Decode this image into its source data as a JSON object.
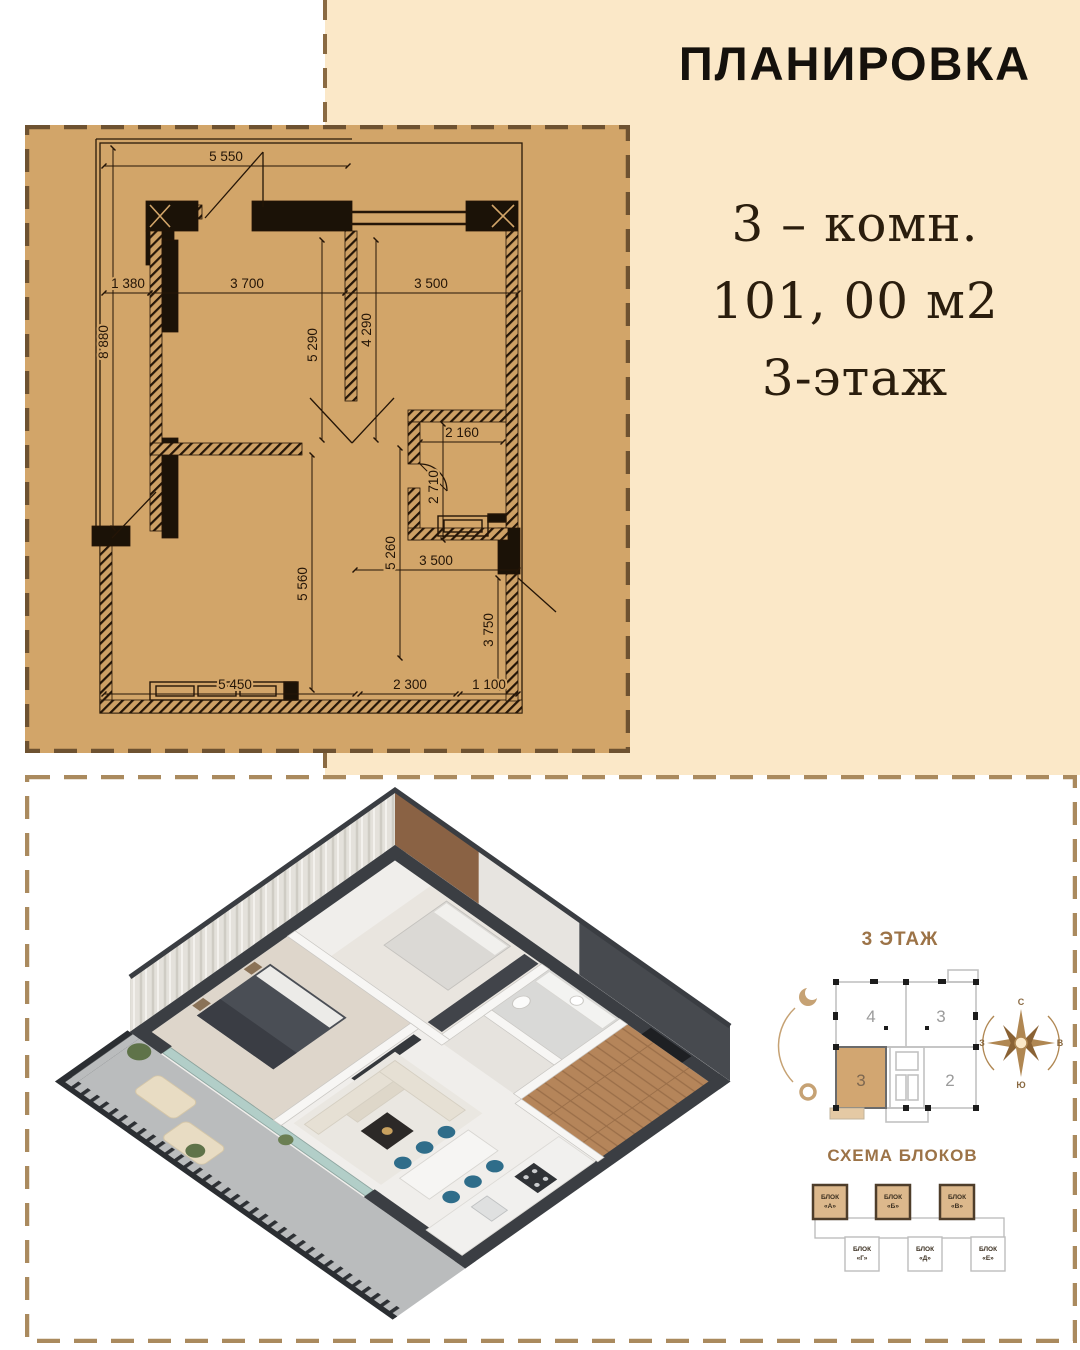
{
  "header": {
    "title": "ПЛАНИРОВКА"
  },
  "apartment": {
    "rooms_line": "3 – комн.",
    "area_line": "101, 00 м2",
    "floor_line": "3-этаж"
  },
  "floor_plan": {
    "dims": [
      "5 550",
      "8 880",
      "1 380",
      "3 700",
      "3 500",
      "5 290",
      "4 290",
      "2 160",
      "2 710",
      "5 260",
      "3 500",
      "5 560",
      "3 750",
      "5 450",
      "2 300",
      "1 100"
    ]
  },
  "floor_scheme": {
    "title": "3 ЭТАЖ",
    "units": [
      "4",
      "3",
      "3",
      "2"
    ],
    "highlighted_unit": "3",
    "compass": {
      "n": "С",
      "e": "В",
      "s": "Ю",
      "w": "З"
    }
  },
  "block_scheme": {
    "title": "СХЕМА БЛОКОВ",
    "top": [
      {
        "label": "БЛОК",
        "letter": "«А»"
      },
      {
        "label": "БЛОК",
        "letter": "«Б»"
      },
      {
        "label": "БЛОК",
        "letter": "«В»"
      }
    ],
    "bottom": [
      {
        "label": "БЛОК",
        "letter": "«Г»"
      },
      {
        "label": "БЛОК",
        "letter": "«Д»"
      },
      {
        "label": "БЛОК",
        "letter": "«Е»"
      }
    ]
  },
  "colors": {
    "cream": "#fbe8c8",
    "tan": "#d2a569",
    "dash_dark": "#6e5231",
    "dash_light": "#aa8a5e",
    "plan_ink": "#241507",
    "scheme_gold": "#b08752",
    "unit_highlight": "#d2a671",
    "accent_teal": "#2f6d8a"
  }
}
